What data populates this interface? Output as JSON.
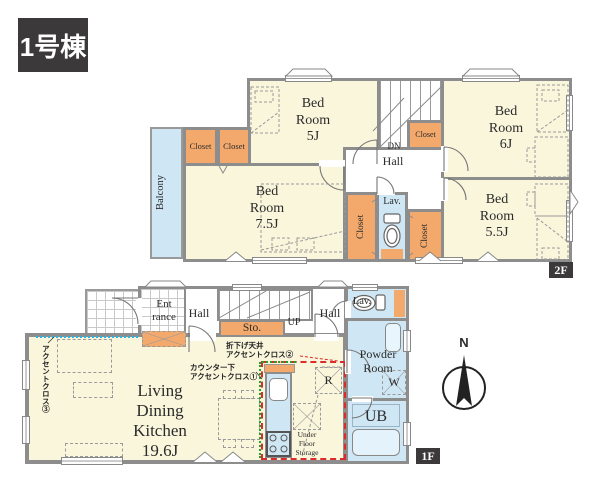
{
  "title": "1号棟",
  "floor_2f": {
    "tag": "2F",
    "bedroom_5": "Bed\nRoom\n5J",
    "bedroom_6": "Bed\nRoom\n6J",
    "bedroom_7_5": "Bed\nRoom\n7.5J",
    "bedroom_5_5": "Bed\nRoom\n5.5J",
    "closet": "Closet",
    "balcony": "Balcony",
    "hall": "Hall",
    "down": "DN",
    "lavatory": "Lav."
  },
  "floor_1f": {
    "tag": "1F",
    "entrance": "Ent\nrance",
    "hall": "Hall",
    "hall_upper": "Hall",
    "storage": "Sto.",
    "up": "UP",
    "lavatory": "Lav.",
    "powder_room": "Powder\nRoom",
    "washer": "W",
    "refrigerator": "R",
    "unit_bath": "UB",
    "under_floor_storage": "Under\nFloor\nStorage",
    "living_dining_kitchen": "Living\nDining\nKitchen\n19.6J",
    "note_ceiling": "折下げ天井\nアクセントクロス②",
    "note_counter": "カウンター下\nアクセントクロス①",
    "note_accent_wall": "アクセントクロス③"
  },
  "compass": {
    "north": "N"
  },
  "colors": {
    "wall": "#8d8d8d",
    "room_fill": "#faf6dc",
    "closet_fill": "#f3a96b",
    "water_fill": "#cfe7f4",
    "tag_bg": "#3b3939",
    "accent_red": "#dd2a2a",
    "accent_green": "#1fa32a",
    "accent_cyan": "#29b5e8"
  }
}
